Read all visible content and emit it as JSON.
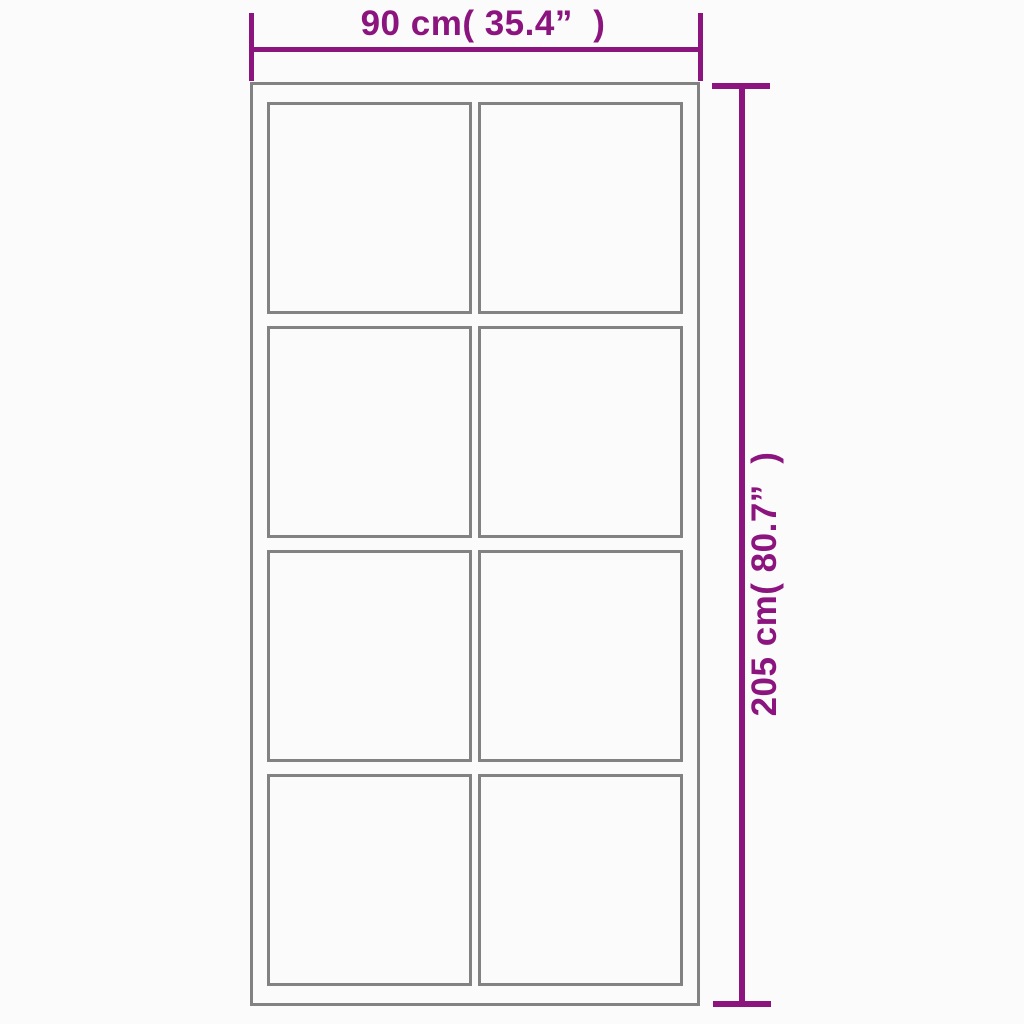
{
  "diagram": {
    "kind": "product-dimension-diagram",
    "subject": "sliding door with glass panels"
  },
  "dimensions": {
    "width_label": "90 cm( 35.4”  )",
    "height_label": "205 cm( 80.7”  )"
  },
  "door": {
    "panel_rows": 4,
    "panel_cols": 2
  },
  "colors": {
    "dimension_accent": "#8C147F",
    "frame_gray": "#828282",
    "background": "#FBFBFB"
  }
}
